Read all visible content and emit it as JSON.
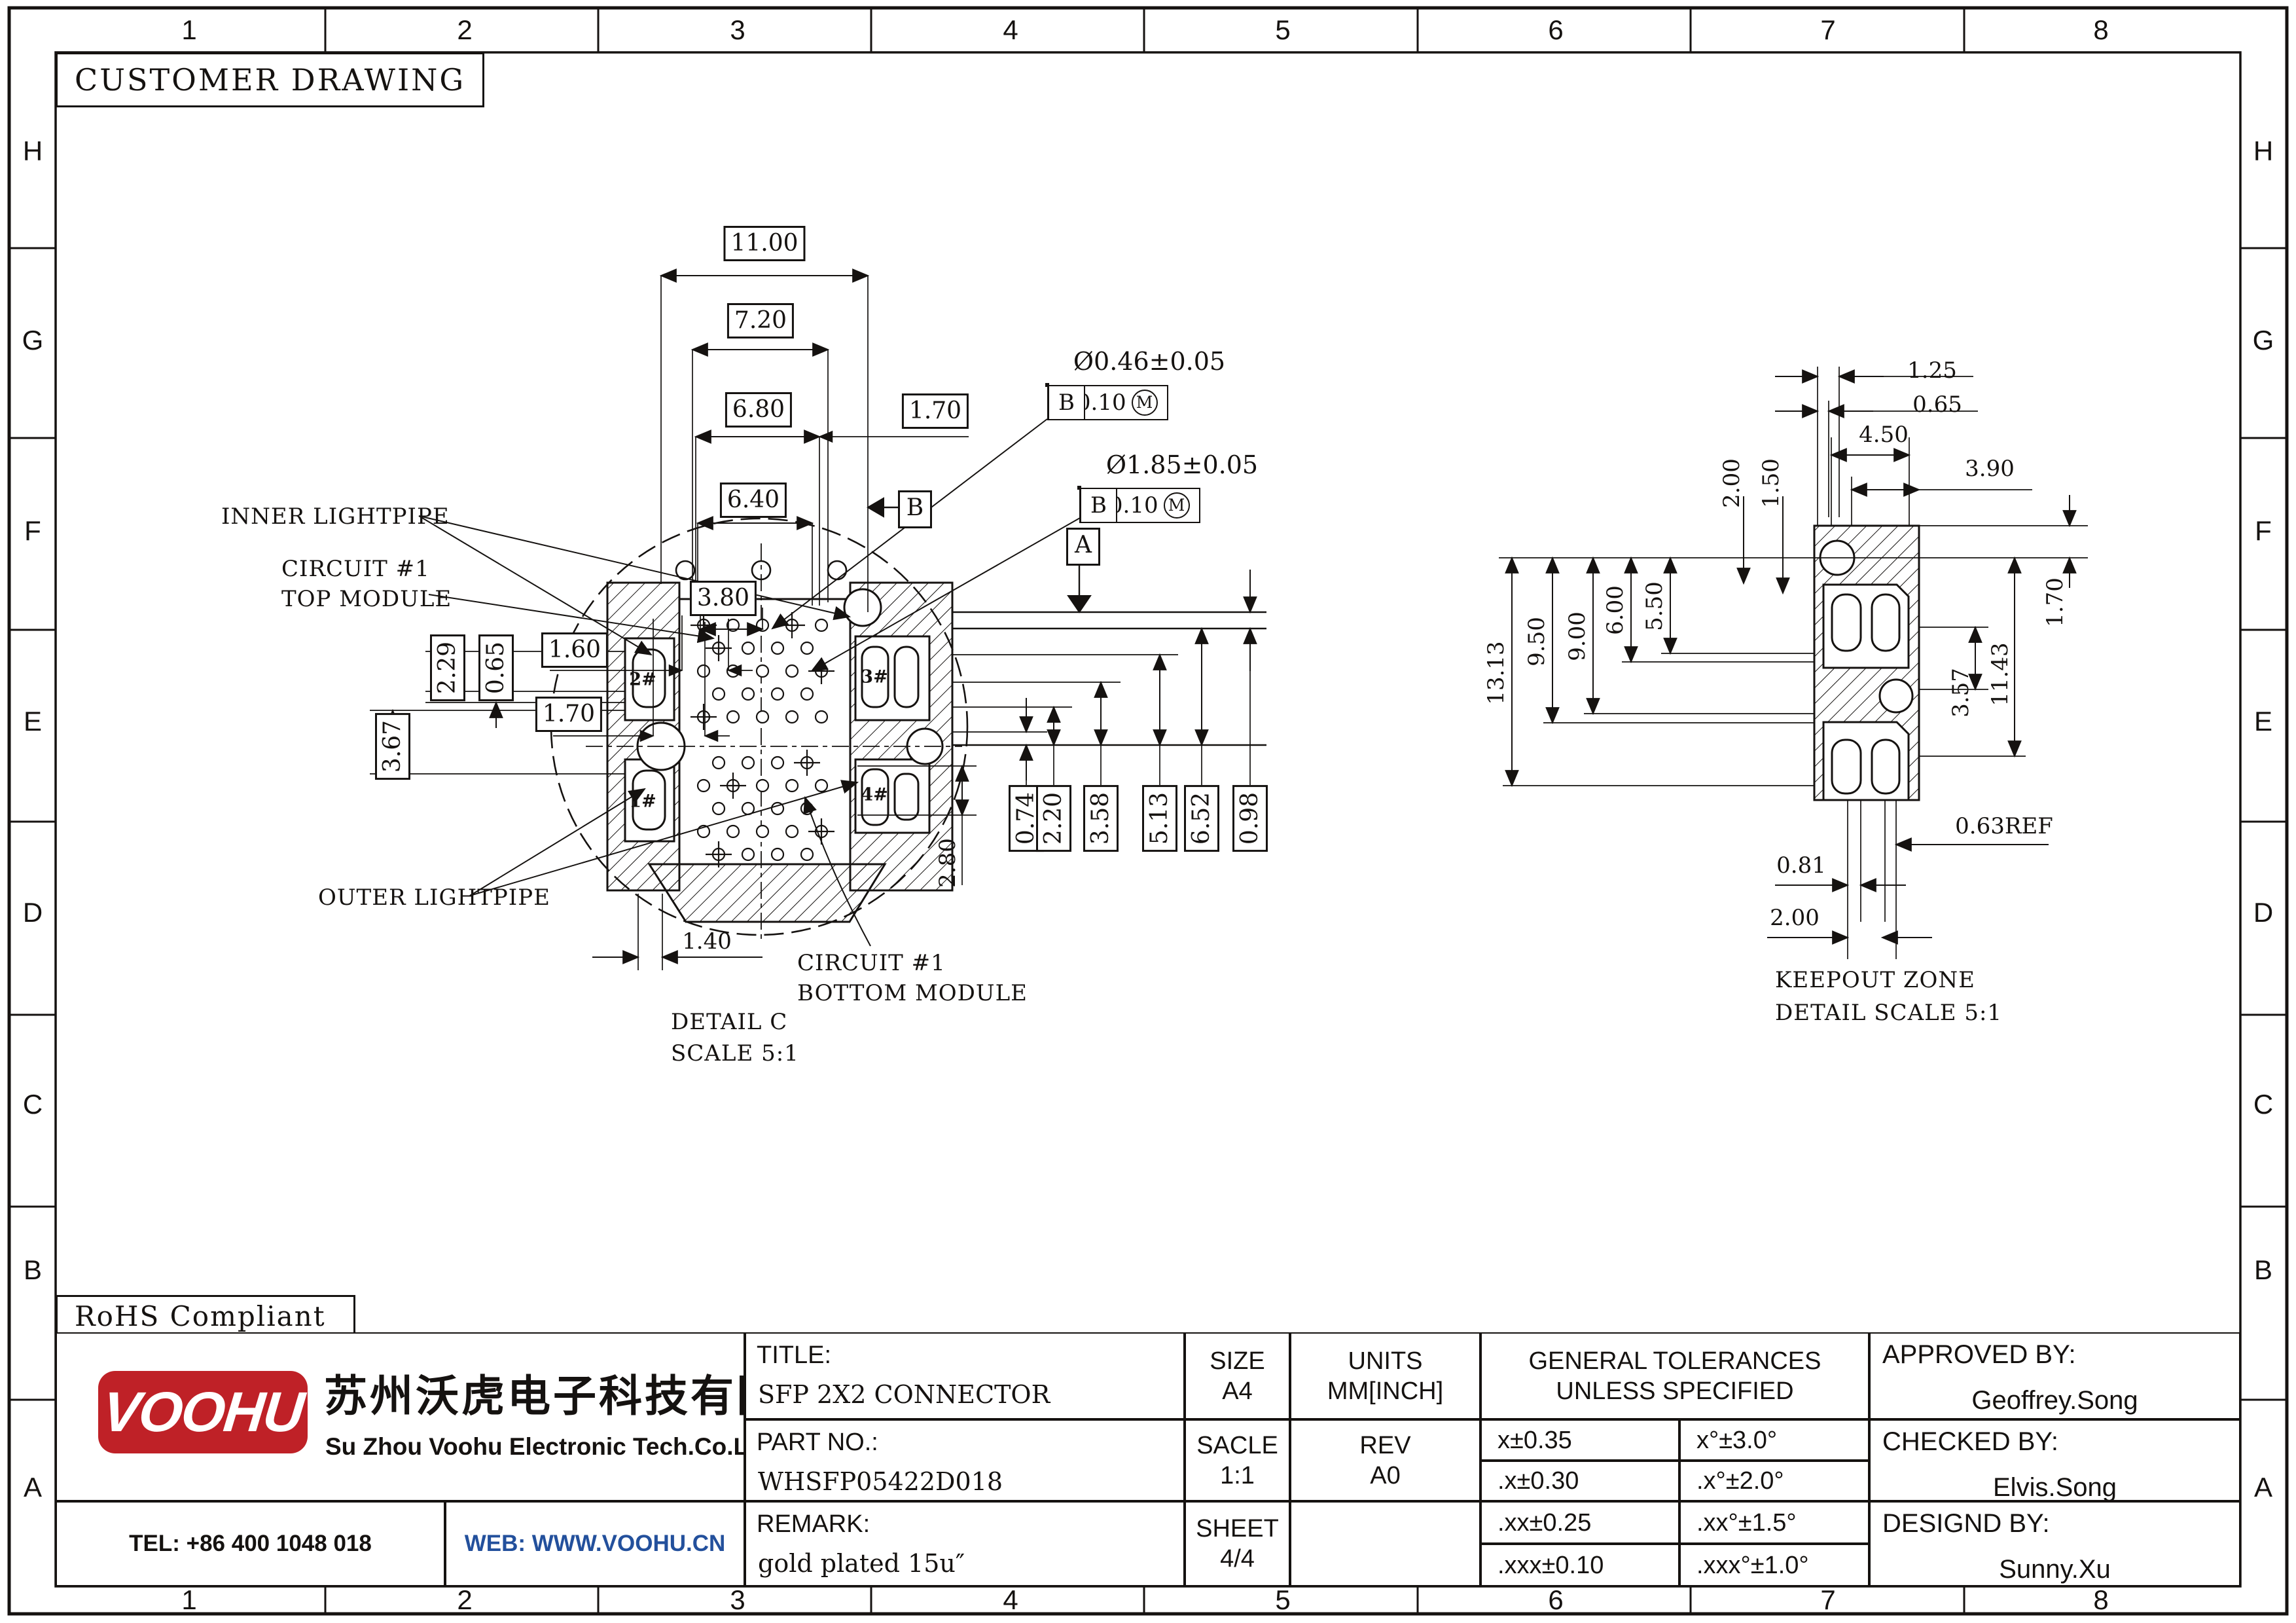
{
  "sheet": {
    "stamp": "CUSTOMER DRAWING",
    "rohs": "RoHS Compliant",
    "cols": [
      "1",
      "2",
      "3",
      "4",
      "5",
      "6",
      "7",
      "8"
    ],
    "rows": [
      "H",
      "G",
      "F",
      "E",
      "D",
      "C",
      "B",
      "A"
    ],
    "colors": {
      "line": "#151210",
      "logo_red": "#bf2127",
      "web_blue": "#23509c"
    }
  },
  "left_view": {
    "caption_1": "DETAIL C",
    "caption_2": "SCALE 5:1",
    "labels": {
      "inner": "INNER LIGHTPIPE",
      "circuit_top_1": "CIRCUIT #1",
      "circuit_top_2": "TOP MODULE",
      "outer": "OUTER LIGHTPIPE",
      "circuit_bot_1": "CIRCUIT #1",
      "circuit_bot_2": "BOTTOM MODULE"
    },
    "pads": {
      "p1": "1#",
      "p2": "2#",
      "p3": "3#",
      "p4": "4#"
    },
    "dims": {
      "w1100": "11.00",
      "w720": "7.20",
      "w680": "6.80",
      "w640": "6.40",
      "w380": "3.80",
      "w170r": "1.70",
      "w160": "1.60",
      "w170l": "1.70",
      "h229": "2.29",
      "h065": "0.65",
      "h367": "3.67",
      "w140": "1.40",
      "h280": "2.80",
      "c074": "0.74",
      "c220": "2.20",
      "c358": "3.58",
      "c513": "5.13",
      "c652": "6.52",
      "c098": "0.98"
    },
    "fcf1": {
      "size": "Ø0.46±0.05",
      "sym": "⌖",
      "tol": "Ø0.10",
      "mod": "M",
      "d1": "A",
      "d2": "B"
    },
    "fcf2": {
      "size": "Ø1.85±0.05",
      "sym": "⌖",
      "tol": "Ø0.10",
      "mod": "M",
      "d1": "A",
      "d2": "B"
    },
    "datum_a": "A",
    "datum_b": "B"
  },
  "right_view": {
    "caption_1": "KEEPOUT ZONE",
    "caption_2": "DETAIL SCALE 5:1",
    "dims": {
      "t125": "1.25",
      "t065": "0.65",
      "t450": "4.50",
      "t390": "3.90",
      "r200": "2.00",
      "r150": "1.50",
      "c1313": "13.13",
      "c950": "9.50",
      "c900": "9.00",
      "c600": "6.00",
      "c550": "5.50",
      "s170": "1.70",
      "s1143": "11.43",
      "s357": "3.57",
      "b063": "0.63REF",
      "b081": "0.81",
      "b200": "2.00"
    }
  },
  "title_block": {
    "title_label": "TITLE:",
    "title": "SFP 2X2 CONNECTOR",
    "part_label": "PART NO.:",
    "part": "WHSFP05422D018",
    "remark_label": "REMARK:",
    "remark": "gold plated 15u″",
    "size_label": "SIZE",
    "size": "A4",
    "units_label": "UNITS",
    "units": "MM[INCH]",
    "scale_label": "SACLE",
    "scale": "1:1",
    "rev_label": "REV",
    "rev": "A0",
    "sheet_label": "SHEET",
    "sheet": "4/4",
    "tol_header_1": "GENERAL TOLERANCES",
    "tol_header_2": "UNLESS SPECIFIED",
    "tol": [
      [
        "x±0.35",
        "x°±3.0°"
      ],
      [
        ".x±0.30",
        ".x°±2.0°"
      ],
      [
        ".xx±0.25",
        ".xx°±1.5°"
      ],
      [
        ".xxx±0.10",
        ".xxx°±1.0°"
      ]
    ],
    "approved_label": "APPROVED BY:",
    "approved": "Geoffrey.Song",
    "checked_label": "CHECKED BY:",
    "checked": "Elvis.Song",
    "designed_label": "DESIGND BY:",
    "designed": "Sunny.Xu"
  },
  "company": {
    "logo": "VOOHU",
    "name_cn": "苏州沃虎电子科技有限公司",
    "name_en": "Su Zhou Voohu Electronic Tech.Co.Ltd",
    "tel": "TEL: +86 400 1048 018",
    "web": "WEB: WWW.VOOHU.CN"
  }
}
